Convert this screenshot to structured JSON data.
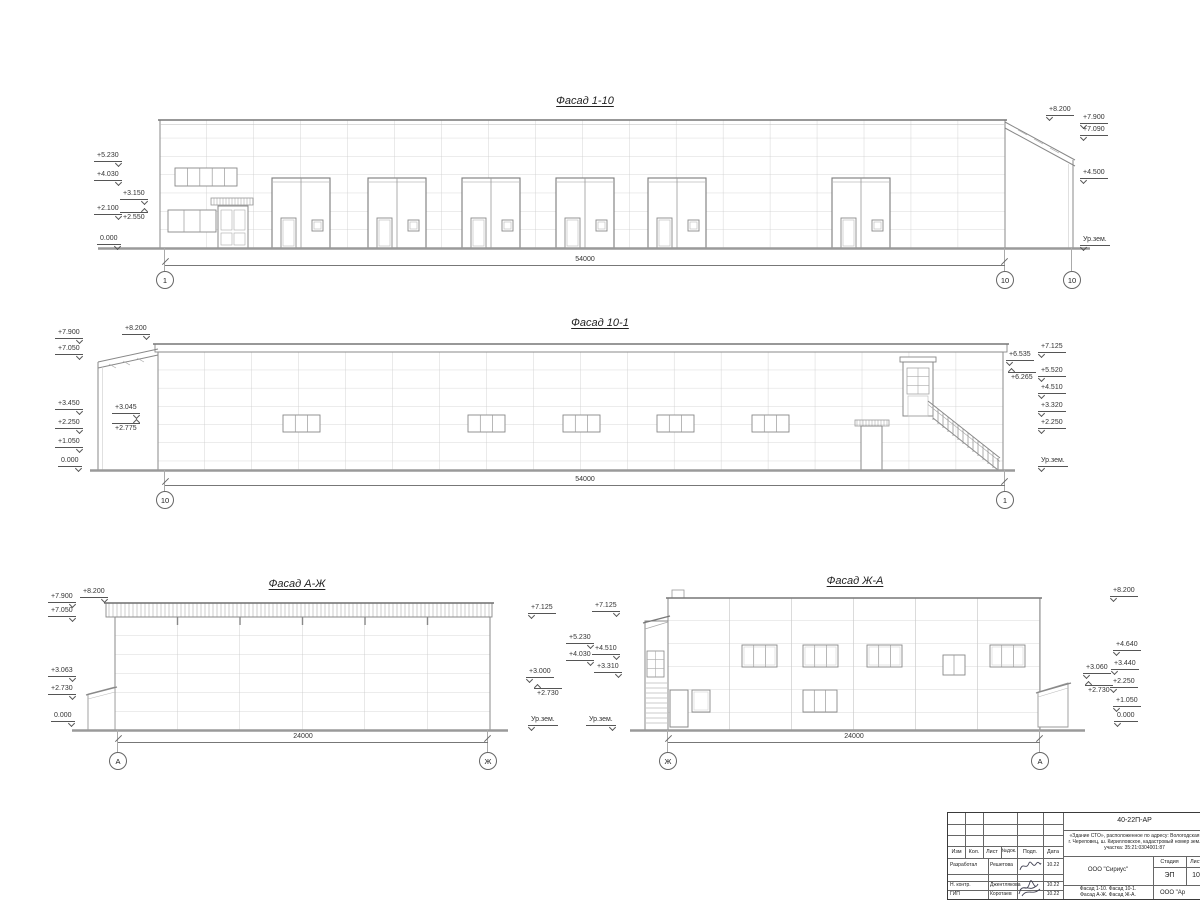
{
  "sheet": {
    "facades": {
      "f1": {
        "title": "Фасад 1-10",
        "dim": "54000",
        "axes": [
          "1",
          "10",
          "10"
        ],
        "marks_left": [
          "+5.230",
          "+4.030",
          "+3.150",
          "+2.100",
          "+2.550",
          "0.000"
        ],
        "marks_right": [
          "+8.200",
          "+7.900",
          "+7.090",
          "+4.500",
          "Ур.зем."
        ]
      },
      "f2": {
        "title": "Фасад 10-1",
        "dim": "54000",
        "axes": [
          "10",
          "1"
        ],
        "marks_left": [
          "+7.900",
          "+8.200",
          "+7.050",
          "+3.450",
          "+3.045",
          "+2.250",
          "+2.775",
          "+1.050",
          "0.000"
        ],
        "marks_right": [
          "+6.535",
          "+6.265",
          "+7.125",
          "+5.520",
          "+4.510",
          "+3.320",
          "+2.250",
          "Ур.зем."
        ]
      },
      "f3": {
        "title": "Фасад А-Ж",
        "dim": "24000",
        "axes": [
          "А",
          "Ж"
        ],
        "marks_left": [
          "+7.900",
          "+8.200",
          "+7.050",
          "+3.063",
          "+2.730",
          "0.000"
        ],
        "marks_right": [
          "+7.125",
          "+3.000",
          "+2.730",
          "Ур.зем."
        ]
      },
      "f4": {
        "title": "Фасад Ж-А",
        "dim": "24000",
        "axes": [
          "Ж",
          "А"
        ],
        "marks_left": [
          "+7.125",
          "+5.230",
          "+4.510",
          "+4.030",
          "+3.310",
          "Ур.зем."
        ],
        "marks_right": [
          "+8.200",
          "+4.640",
          "+3.440",
          "+3.060",
          "+2.730",
          "+2.250",
          "+1.050",
          "0.000"
        ]
      }
    },
    "title_block": {
      "code": "40-22П-АР",
      "object_line1": "«Здание СТО», расположенное по адресу: Вологодская",
      "object_line2": "г. Череповец, ш. Кирилловское, кадастровый номер зем.",
      "object_line3": "участка: 35:21:0304001:87",
      "columns": [
        "Изм",
        "Кол.",
        "Лист",
        "№док.",
        "Подп.",
        "Дата"
      ],
      "rows": [
        {
          "role": "Разработал",
          "name": "Решетова",
          "date": "10.22"
        },
        {
          "role": "Н. контр.",
          "name": "Джентлякова",
          "date": "10.22"
        },
        {
          "role": "ГИП",
          "name": "Коротаев",
          "date": "10.22"
        }
      ],
      "org": "ООО \"Сириус\"",
      "stage_label": "Стадия",
      "stage": "ЭП",
      "sheet_label": "Лист",
      "sheet_no": "10",
      "content_line1": "Фасад 1-10. Фасад 10-1.",
      "content_line2": "Фасад А-Ж. Фасад Ж-А.",
      "org2": "ООО \"Ар"
    }
  }
}
